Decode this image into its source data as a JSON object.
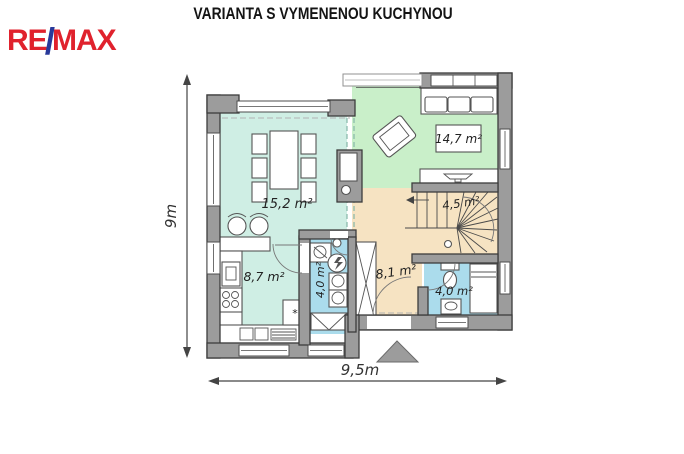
{
  "header": {
    "title": "VARIANTA S VYMENENOU KUCHYNOU"
  },
  "logo": {
    "re": "RE",
    "slash": "/",
    "max": "MAX",
    "red": "#e0222d",
    "blue": "#28399a"
  },
  "plan": {
    "dimensions": {
      "vertical": "9m",
      "horizontal": "9,5m"
    },
    "rooms": {
      "dining": {
        "label": "15,2 m²",
        "color": "#cfeee4"
      },
      "kitchen": {
        "label": "8,7 m²",
        "color": "#cfeee4"
      },
      "living": {
        "label": "14,7 m²",
        "color": "#c9efc9"
      },
      "stairs": {
        "label": "4,5 m²",
        "color": "#f6e3c2"
      },
      "hall": {
        "label": "8,1 m²",
        "color": "#f6e3c2"
      },
      "utility": {
        "label": "4,0 m²",
        "color": "#abdcec"
      },
      "bathroom": {
        "label": "4,0 m²",
        "color": "#abdcec"
      }
    },
    "colors": {
      "wall": "#9c9c9c",
      "wall_outline": "#3c3c3c",
      "furniture_outline": "#555555"
    },
    "icons": {
      "fridge_snowflake": "*"
    }
  }
}
